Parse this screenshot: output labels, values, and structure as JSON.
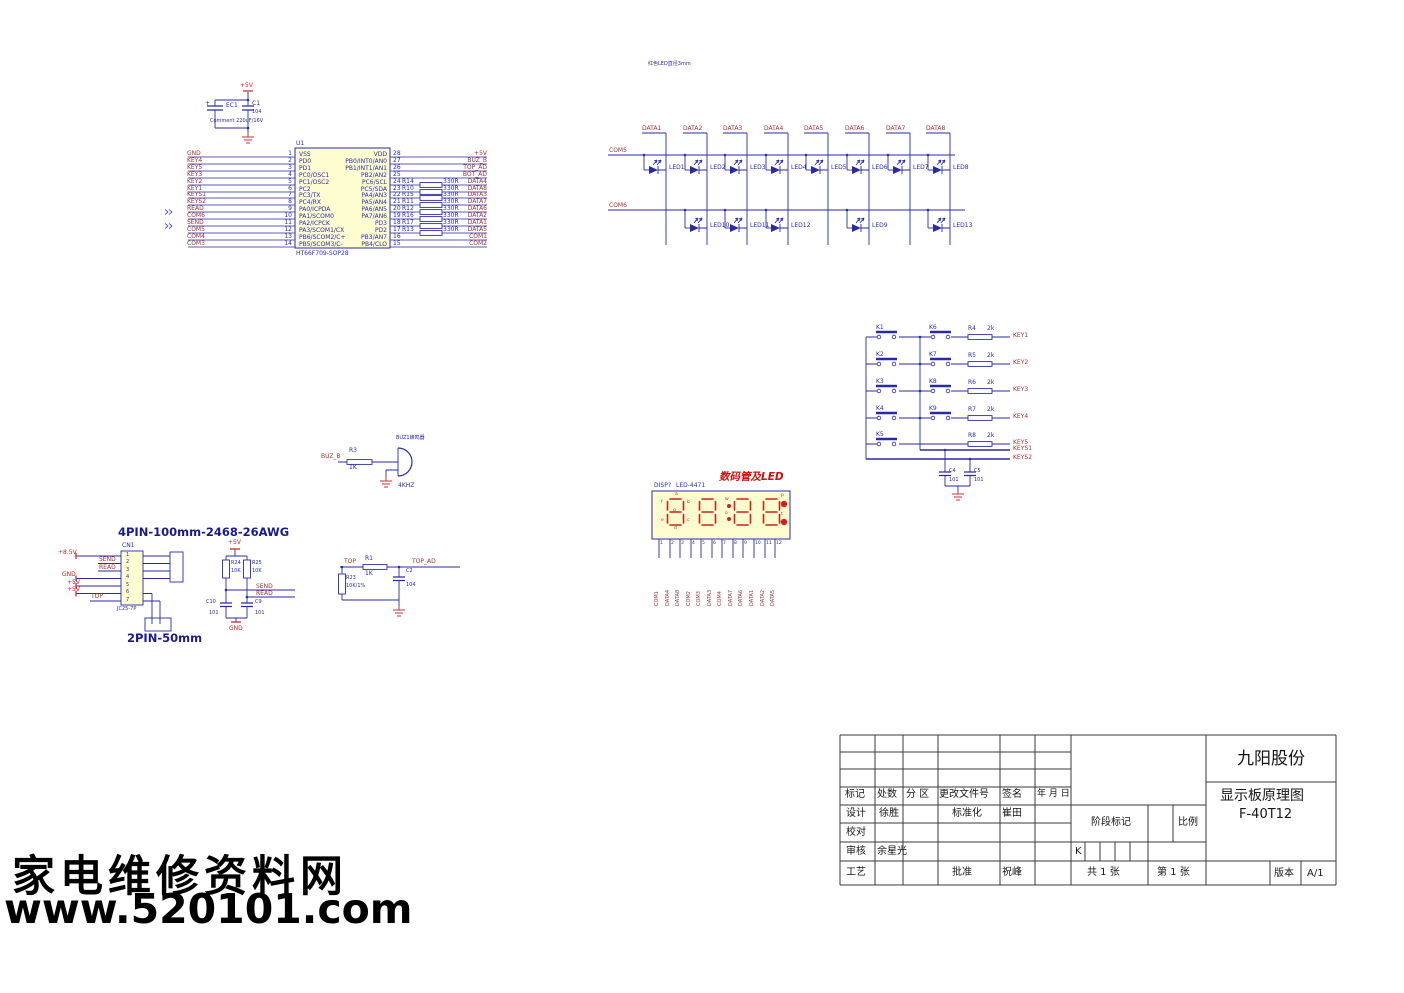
{
  "watermark": {
    "line1": "家电维修资料网",
    "line2": "www.520101.com"
  },
  "power": {
    "rail": "+5V",
    "plus": "+",
    "ec_ref": "EC1",
    "ec_note": "Comment 220uF/16V",
    "c_ref": "C1",
    "c_val": "104"
  },
  "mcu": {
    "ref": "U1",
    "part": "HT66F709-SOP28",
    "left_pins": [
      {
        "net": "GND",
        "num": "1",
        "name": "VSS"
      },
      {
        "net": "KEY4",
        "num": "2",
        "name": "PD0"
      },
      {
        "net": "KEY5",
        "num": "3",
        "name": "PD1"
      },
      {
        "net": "KEY3",
        "num": "4",
        "name": "PC0/OSC1"
      },
      {
        "net": "KEY2",
        "num": "5",
        "name": "PC1/OSC2"
      },
      {
        "net": "KEY1",
        "num": "6",
        "name": "PC2"
      },
      {
        "net": "KEYS1",
        "num": "7",
        "name": "PC3/TX"
      },
      {
        "net": "KEYS2",
        "num": "8",
        "name": "PC4/RX"
      },
      {
        "net": "READ",
        "num": "9",
        "name": "PA0/ICPDA"
      },
      {
        "net": "COM6",
        "num": "10",
        "name": "PA1/SCOM0"
      },
      {
        "net": "SEND",
        "num": "11",
        "name": "PA2/ICPCK"
      },
      {
        "net": "COM5",
        "num": "12",
        "name": "PA3/SCOM1/CX"
      },
      {
        "net": "COM4",
        "num": "13",
        "name": "PB6/SCOM2/C+"
      },
      {
        "net": "COM3",
        "num": "14",
        "name": "PB5/SCOM3/C-"
      }
    ],
    "right_pins": [
      {
        "name": "VDD",
        "num": "28",
        "net": "+5V"
      },
      {
        "name": "PB0/INT0/AN0",
        "num": "27",
        "net": "BUZ_B"
      },
      {
        "name": "PB1/INT1/AN1",
        "num": "26",
        "net": "TOP_AD"
      },
      {
        "name": "PB2/AN2",
        "num": "25",
        "net": "BOT_AD"
      },
      {
        "name": "PC6/SCL",
        "num": "24",
        "res": "R14",
        "val": "330R",
        "net": "DATA4"
      },
      {
        "name": "PC5/SDA",
        "num": "23",
        "res": "R10",
        "val": "330R",
        "net": "DATA8"
      },
      {
        "name": "PA4/AN3",
        "num": "22",
        "res": "R15",
        "val": "330R",
        "net": "DATA3"
      },
      {
        "name": "PA5/AN4",
        "num": "21",
        "res": "R11",
        "val": "330R",
        "net": "DATA7"
      },
      {
        "name": "PA6/AN5",
        "num": "20",
        "res": "R12",
        "val": "330R",
        "net": "DATA6"
      },
      {
        "name": "PA7/AN6",
        "num": "19",
        "res": "R16",
        "val": "330R",
        "net": "DATA2"
      },
      {
        "name": "PD3",
        "num": "18",
        "res": "R17",
        "val": "330R",
        "net": "DATA1"
      },
      {
        "name": "PD2",
        "num": "17",
        "res": "R13",
        "val": "330R",
        "net": "DATA5"
      },
      {
        "name": "PB3/AN7",
        "num": "16",
        "net": "COM1"
      },
      {
        "name": "PB4/CLO",
        "num": "15",
        "net": "COM2"
      }
    ]
  },
  "led_array": {
    "note": "红色LED直径3mm",
    "data_labels": [
      "DATA1",
      "DATA2",
      "DATA3",
      "DATA4",
      "DATA5",
      "DATA6",
      "DATA7",
      "DATA8"
    ],
    "com_top": "COM5",
    "com_bottom": "COM6",
    "row1": [
      "LED1",
      "LED2",
      "LED3",
      "LED4",
      "LED5",
      "LED6",
      "LED7",
      "LED8"
    ],
    "row2": [
      "LED10",
      "LED11",
      "LED12",
      "LED9",
      "LED13"
    ]
  },
  "keys": {
    "left": [
      "K1",
      "K2",
      "K3",
      "K4",
      "K5"
    ],
    "right": [
      "K6",
      "K7",
      "K8",
      "K9"
    ],
    "res": [
      {
        "ref": "R4",
        "val": "2k"
      },
      {
        "ref": "R5",
        "val": "2k"
      },
      {
        "ref": "R6",
        "val": "2k"
      },
      {
        "ref": "R7",
        "val": "2k"
      },
      {
        "ref": "R8",
        "val": "2k"
      }
    ],
    "nets": [
      "KEY1",
      "KEY2",
      "KEY3",
      "KEY4",
      "KEY5"
    ],
    "sense": [
      "KEYS1",
      "KEYS2"
    ],
    "caps": [
      {
        "ref": "C4",
        "val": "101"
      },
      {
        "ref": "C5",
        "val": "101"
      }
    ]
  },
  "buzzer": {
    "net": "BUZ_B",
    "res_ref": "R3",
    "res_val": "1K",
    "ref": "BUZ1蜂鸣器",
    "freq": "4KHZ"
  },
  "display": {
    "title": "数码管及LED",
    "ref": "DISP?",
    "part": "LED-4471",
    "segs": [
      "a",
      "f",
      "b",
      "g",
      "e",
      "c",
      "d"
    ],
    "dots": [
      "w",
      "o",
      "P",
      "t"
    ],
    "pins": [
      "1",
      "2",
      "3",
      "4",
      "5",
      "6",
      "7",
      "8",
      "9",
      "10",
      "11",
      "12"
    ],
    "nets": [
      "COM1",
      "DATA4",
      "DATA8",
      "COM2",
      "COM3",
      "DATA3",
      "COM4",
      "DATA7",
      "DATA6",
      "DATA1",
      "DATA2",
      "DATA5"
    ]
  },
  "harness": {
    "title": "4PIN-100mm-2468-26AWG",
    "ref": "CN1",
    "part": "JC25-7P",
    "pins": [
      "1",
      "2",
      "3",
      "4",
      "5",
      "6",
      "7"
    ],
    "nets": [
      "+8.5V",
      "SEND",
      "READ",
      "GND",
      "+5V",
      "+5V",
      "TOP"
    ],
    "tail": "2PIN-50mm"
  },
  "pullups": {
    "rail": "+5V",
    "r24_ref": "R24",
    "r24_val": "10K",
    "r25_ref": "R25",
    "r25_val": "10K",
    "send": "SEND",
    "read": "READ",
    "c10_ref": "C10",
    "c10_val": "101",
    "c9_ref": "C9",
    "c9_val": "101",
    "gnd": "GND"
  },
  "top_filter": {
    "in": "TOP",
    "r1_ref": "R1",
    "r1_val": "1K",
    "out": "TOP_AD",
    "r23_ref": "R23",
    "r23_val": "10K/1%",
    "c2_ref": "C2",
    "c2_val": "104"
  },
  "titleblock": {
    "company": "九阳股份",
    "doc_title": "显示板原理图",
    "model": "F-40T12",
    "headers": [
      "标记",
      "处数",
      "分 区",
      "更改文件号",
      "签名",
      "年 月 日"
    ],
    "rows": [
      {
        "c0": "设计",
        "c1": "徐胜",
        "c2": "标准化",
        "c3": "崔田"
      },
      {
        "c0": "校对"
      },
      {
        "c0": "审核",
        "c1": "余星光"
      },
      {
        "c0": "工艺",
        "c2": "批准",
        "c3": "祝峰"
      }
    ],
    "stage": "阶段标记",
    "scale": "比例",
    "k": "K",
    "sheets": "共 1 张",
    "sheet_no": "第 1 张",
    "ver_label": "版本",
    "ver": "A/1"
  }
}
